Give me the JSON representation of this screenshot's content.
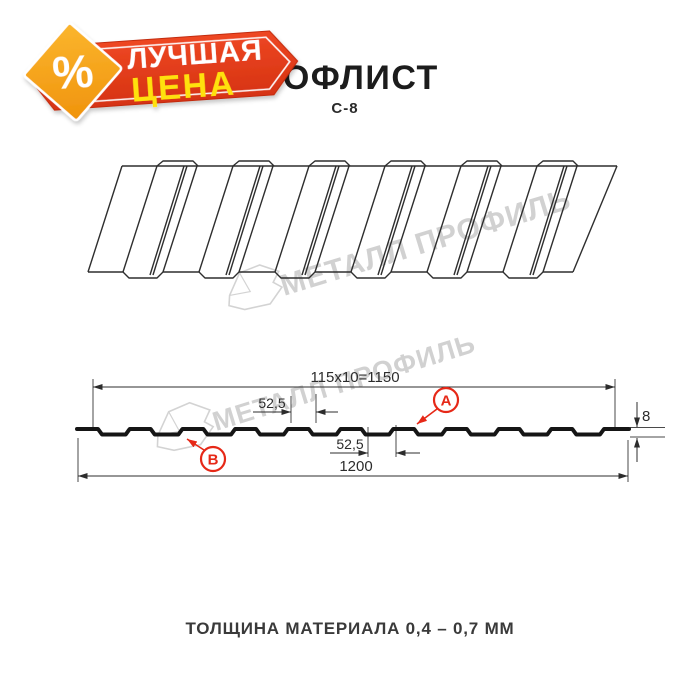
{
  "badge": {
    "percent": "%",
    "line1": "ЛУЧШАЯ",
    "line2": "ЦЕНА",
    "banner_color": "#e8411f",
    "banner_color_dark": "#d63312",
    "diamond_color": "#f9ac20",
    "diamond_color_dark": "#f0930c",
    "line2_color": "#ffe10a"
  },
  "header": {
    "title": "ПРОФЛИСТ",
    "subtitle": "С-8"
  },
  "watermark": {
    "text": "МЕТАЛЛ ПРОФИЛЬ",
    "color": "#c6c6c6"
  },
  "diagram": {
    "dim_total_top": "115x10=1150",
    "dim_pitch_top": "52,5",
    "dim_pitch_bottom": "52,5",
    "dim_overall_width": "1200",
    "dim_height": "8",
    "label_a": "А",
    "label_b": "В",
    "accent_color": "#e62817",
    "line_color": "#3a3a3a"
  },
  "footer": {
    "text": "ТОЛЩИНА МАТЕРИАЛА 0,4 – 0,7 ММ"
  }
}
